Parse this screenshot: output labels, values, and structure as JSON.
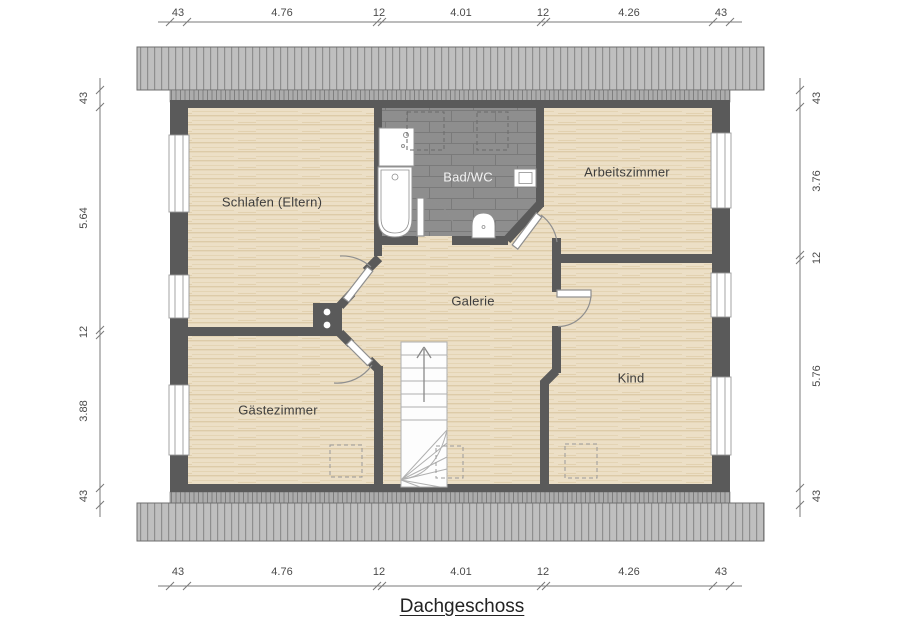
{
  "title": "Dachgeschoss",
  "rooms": {
    "schlafen": "Schlafen (Eltern)",
    "bad": "Bad/WC",
    "arbeitszimmer": "Arbeitszimmer",
    "galerie": "Galerie",
    "gaestezimmer": "Gästezimmer",
    "kind": "Kind"
  },
  "dimensions": {
    "top": [
      "43",
      "4.76",
      "12",
      "4.01",
      "12",
      "4.26",
      "43"
    ],
    "bottom": [
      "43",
      "4.76",
      "12",
      "4.01",
      "12",
      "4.26",
      "43"
    ],
    "left": [
      "43",
      "5.64",
      "12",
      "3.88",
      "43"
    ],
    "right": [
      "43",
      "3.76",
      "12",
      "5.76",
      "43"
    ]
  },
  "colors": {
    "wall": "#5a5a5a",
    "roof": "#bfbfbf",
    "floor": "#ecdfc6",
    "bath_floor": "#8e8e8e"
  }
}
